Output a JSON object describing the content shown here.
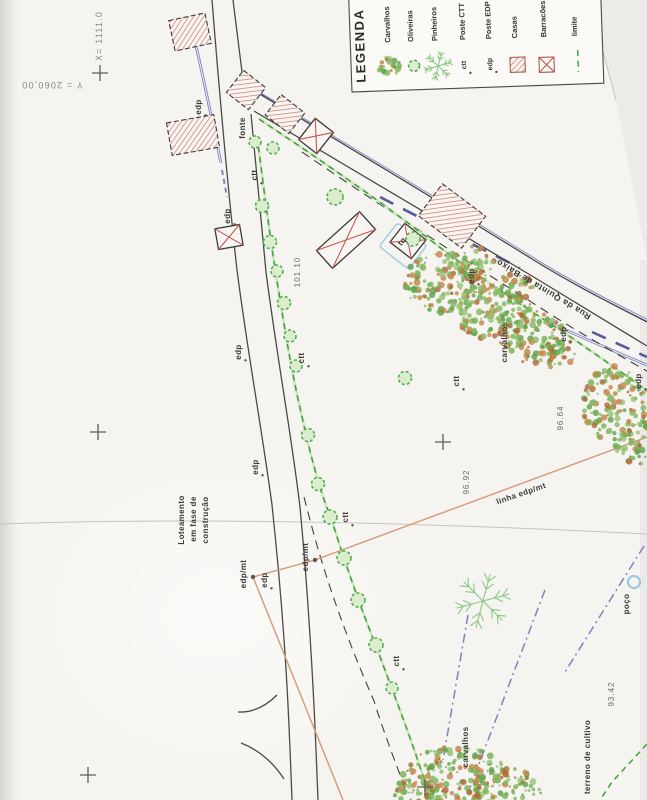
{
  "legend": {
    "title": "LEGENDA",
    "items": [
      {
        "label": "Carvalhos",
        "symbol": "oak-tree"
      },
      {
        "label": "Oliveiras",
        "symbol": "olive-tree"
      },
      {
        "label": "Pinheiros",
        "symbol": "pine-tree"
      },
      {
        "label": "Poste CTT",
        "symbol": "ctt-pole",
        "symbol_text": "ctt"
      },
      {
        "label": "Poste EDP",
        "symbol": "edp-pole",
        "symbol_text": "edp"
      },
      {
        "label": "Casas",
        "symbol": "hatched-square"
      },
      {
        "label": "Barracões",
        "symbol": "crossed-square"
      },
      {
        "label": "limite",
        "symbol": "green-dashed-line"
      }
    ]
  },
  "map": {
    "labels": [
      {
        "t": "X= 1111.0",
        "x": 102,
        "y": 36,
        "r": -90,
        "c": "coord"
      },
      {
        "t": "Y = 2060,00",
        "x": 52,
        "y": 82,
        "r": 180,
        "c": "coord"
      },
      {
        "t": "edp",
        "x": 201,
        "y": 107,
        "r": -90,
        "c": "lbl"
      },
      {
        "t": "fonte",
        "x": 245,
        "y": 128,
        "r": -90,
        "c": "lbl"
      },
      {
        "t": "ctt",
        "x": 257,
        "y": 175,
        "r": -90,
        "c": "lbl"
      },
      {
        "t": "edp",
        "x": 230,
        "y": 216,
        "r": -90,
        "c": "lbl"
      },
      {
        "t": "tq",
        "x": 404,
        "y": 243,
        "r": -52,
        "c": "lbl"
      },
      {
        "t": "101.10",
        "x": 300,
        "y": 272,
        "r": -90,
        "c": "elev"
      },
      {
        "t": "edp",
        "x": 474,
        "y": 276,
        "r": -90,
        "c": "lbl"
      },
      {
        "t": "Rua da Quinta de Baixo",
        "x": 545,
        "y": 287,
        "r": 211,
        "c": "street"
      },
      {
        "t": "carvalhos",
        "x": 507,
        "y": 342,
        "r": -90,
        "c": "lbl"
      },
      {
        "t": "edp",
        "x": 566,
        "y": 334,
        "r": -90,
        "c": "lbl"
      },
      {
        "t": "edp",
        "x": 241,
        "y": 352,
        "r": -90,
        "c": "lbl"
      },
      {
        "t": "ctt",
        "x": 304,
        "y": 358,
        "r": -90,
        "c": "lbl"
      },
      {
        "t": "ctt",
        "x": 459,
        "y": 381,
        "r": -90,
        "c": "lbl"
      },
      {
        "t": "edp",
        "x": 641,
        "y": 381,
        "r": -90,
        "c": "lbl"
      },
      {
        "t": "96.64",
        "x": 563,
        "y": 418,
        "r": -90,
        "c": "elev"
      },
      {
        "t": "edp",
        "x": 258,
        "y": 467,
        "r": -90,
        "c": "lbl"
      },
      {
        "t": "96.92",
        "x": 469,
        "y": 482,
        "r": -90,
        "c": "elev"
      },
      {
        "t": "linha edp/mt",
        "x": 522,
        "y": 496,
        "r": -19,
        "c": "lbl"
      },
      {
        "t": "ctt",
        "x": 348,
        "y": 517,
        "r": -90,
        "c": "lbl"
      },
      {
        "t": "Loteamento",
        "x": 184,
        "y": 520,
        "r": -90,
        "c": "lbl"
      },
      {
        "t": "em fase de",
        "x": 196,
        "y": 519,
        "r": -90,
        "c": "lbl"
      },
      {
        "t": "construção",
        "x": 208,
        "y": 520,
        "r": -90,
        "c": "lbl"
      },
      {
        "t": "edp/mt",
        "x": 246,
        "y": 574,
        "r": -90,
        "c": "lbl"
      },
      {
        "t": "edp/mt",
        "x": 308,
        "y": 557,
        "r": -90,
        "c": "lbl"
      },
      {
        "t": "edp",
        "x": 267,
        "y": 580,
        "r": -90,
        "c": "lbl"
      },
      {
        "t": "poço",
        "x": 629,
        "y": 604,
        "r": -90,
        "c": "lbl"
      },
      {
        "t": "ctt",
        "x": 399,
        "y": 661,
        "r": -90,
        "c": "lbl"
      },
      {
        "t": "93.42",
        "x": 614,
        "y": 694,
        "r": -90,
        "c": "elev"
      },
      {
        "t": "carvalhos",
        "x": 468,
        "y": 747,
        "r": -90,
        "c": "lbl"
      },
      {
        "t": "terreno de cultivo",
        "x": 590,
        "y": 757,
        "r": -90,
        "c": "lbl"
      }
    ],
    "paths": [
      {
        "n": "page-edge",
        "d": "M589,0 L616,100",
        "c": "fold"
      },
      {
        "n": "fold-line",
        "d": "M0,524 C200,517 430,523 647,534",
        "c": "fold"
      },
      {
        "n": "wall-blue",
        "d": "M196,46 C203,76 209,106 215,134 L221,163",
        "c": "blue2"
      },
      {
        "n": "wall-blue-dashes",
        "d": "M222,170 L227,197",
        "c": "bluedash2"
      },
      {
        "n": "roadside-blue-upper",
        "d": "M259,93 C342,142 442,202 542,264 C580,287 616,305 647,320",
        "c": "blue2"
      },
      {
        "n": "roadside-blue-lower",
        "d": "M548,322 C583,338 616,352 647,365",
        "c": "blue2"
      },
      {
        "n": "road-center-dashes-1",
        "d": "M380,197 C428,222 478,247 520,268",
        "c": "navy"
      },
      {
        "n": "road-center-dashes-2",
        "d": "M592,332 L647,357",
        "c": "navy"
      },
      {
        "n": "road-main-left",
        "d": "M212,0 C220,100 228,190 237,270 C248,355 262,430 272,505 C280,580 285,645 288,705 C290,745 291,775 292,800",
        "c": "road"
      },
      {
        "n": "road-main-right-a",
        "d": "M233,0 C238,42 241,66 244,88",
        "c": "road"
      },
      {
        "n": "road-main-right-b",
        "d": "M251,114 C256,168 262,225 266,272 C277,357 291,432 300,507 C307,582 311,646 314,706 C316,746 317,776 318,800",
        "c": "road"
      },
      {
        "n": "road-branch-upper",
        "d": "M247,86 C330,136 432,197 532,259 C572,284 612,304 647,322",
        "c": "road"
      },
      {
        "n": "road-branch-lower",
        "d": "M254,111 C336,159 432,216 532,276 C576,303 613,325 647,346",
        "c": "road"
      },
      {
        "n": "limit-black-dash-branch",
        "d": "M302,152 C382,207 470,263 558,319 C594,341 622,357 647,371",
        "c": "blkdash"
      },
      {
        "n": "limit-green-branch",
        "d": "M259,119 C322,161 382,202 442,249 C482,279 522,306 562,331 C592,352 622,372 647,391",
        "c": "green2"
      },
      {
        "n": "limit-green-main",
        "d": "M257,136 C263,182 269,231 277,281 C285,331 292,375 303,421 C312,462 321,494 331,518 C344,559 358,601 376,646 C392,689 409,733 421,770 C426,783 429,792 431,800",
        "c": "green2"
      },
      {
        "n": "limit-black-dash-main",
        "d": "M304,497 C313,532 322,566 339,613 C351,647 364,678 374,701 C387,742 397,766 406,791",
        "c": "blkdash"
      },
      {
        "n": "curb-arc-1",
        "d": "M238,712 Q259,713 277,695",
        "c": "road"
      },
      {
        "n": "curb-arc-2",
        "d": "M241,743 Q267,753 284,779",
        "c": "road"
      },
      {
        "n": "power-line-1",
        "d": "M253,577 L315,560 L647,437",
        "c": "orange"
      },
      {
        "n": "power-line-2",
        "d": "M253,577 L343,800",
        "c": "orange"
      },
      {
        "n": "field-line-1",
        "d": "M644,546 L565,672",
        "c": "bluedd"
      },
      {
        "n": "field-line-2",
        "d": "M545,590 L468,793",
        "c": "bluedd"
      },
      {
        "n": "field-line-3",
        "d": "M468,615 L443,760",
        "c": "bluedd"
      },
      {
        "n": "limit-green-corner",
        "d": "M647,744 L612,782 L600,800",
        "c": "greendash"
      }
    ],
    "buildings": [
      {
        "type": "casa",
        "cx": 190,
        "cy": 32,
        "w": 37,
        "h": 31,
        "rot": -12
      },
      {
        "type": "casa",
        "cx": 193,
        "cy": 135,
        "w": 48,
        "h": 33,
        "rot": -10
      },
      {
        "type": "casa",
        "cx": 246,
        "cy": 90,
        "w": 28,
        "h": 28,
        "rot": 38
      },
      {
        "type": "casa",
        "cx": 285,
        "cy": 114,
        "w": 30,
        "h": 26,
        "rot": 38
      },
      {
        "type": "casa",
        "cx": 452,
        "cy": 216,
        "w": 54,
        "h": 40,
        "rot": 37
      },
      {
        "type": "barracao",
        "cx": 316,
        "cy": 136,
        "w": 23,
        "h": 27,
        "rot": 38
      },
      {
        "type": "barracao",
        "cx": 229,
        "cy": 237,
        "w": 25,
        "h": 21,
        "rot": -10
      },
      {
        "type": "barracao",
        "cx": 346,
        "cy": 240,
        "w": 58,
        "h": 24,
        "rot": -42
      },
      {
        "type": "bluebox",
        "cx": 403,
        "cy": 246,
        "w": 37,
        "h": 30,
        "rot": 38
      },
      {
        "type": "barracao",
        "cx": 408,
        "cy": 241,
        "w": 27,
        "h": 24,
        "rot": 38
      }
    ],
    "olive_trees": [
      [
        255,
        142,
        6
      ],
      [
        273,
        148,
        6
      ],
      [
        335,
        197,
        8
      ],
      [
        413,
        239,
        7
      ],
      [
        262,
        206,
        6.5
      ],
      [
        270,
        242,
        6.5
      ],
      [
        277,
        271,
        6
      ],
      [
        284,
        303,
        6.5
      ],
      [
        290,
        336,
        6
      ],
      [
        296,
        366,
        6
      ],
      [
        308,
        435,
        6.5
      ],
      [
        318,
        484,
        6.5
      ],
      [
        330,
        517,
        7
      ],
      [
        344,
        558,
        7
      ],
      [
        358,
        600,
        7
      ],
      [
        376,
        645,
        7
      ],
      [
        392,
        688,
        6
      ],
      [
        405,
        378,
        6.5
      ]
    ],
    "oak_clusters": [
      [
        445,
        283,
        42,
        30
      ],
      [
        492,
        312,
        40,
        28
      ],
      [
        533,
        337,
        34,
        26
      ],
      [
        470,
        262,
        24,
        16
      ],
      [
        513,
        288,
        22,
        15
      ],
      [
        556,
        352,
        20,
        16
      ],
      [
        614,
        404,
        32,
        38
      ],
      [
        638,
        442,
        24,
        22
      ],
      [
        455,
        775,
        52,
        28
      ],
      [
        505,
        788,
        38,
        20
      ],
      [
        420,
        792,
        28,
        16
      ]
    ],
    "pine_trees": [
      [
        483,
        601,
        27
      ]
    ],
    "well": {
      "x": 634,
      "y": 582,
      "r": 6
    },
    "poles": [
      [
        253,
        577
      ],
      [
        315,
        560
      ]
    ],
    "crosses": [
      [
        100,
        73
      ],
      [
        98,
        432
      ],
      [
        443,
        442
      ],
      [
        88,
        775
      ],
      [
        425,
        787
      ]
    ]
  },
  "colors": {
    "paper": "#f5f4f0",
    "hatch_red": "#cf7f72",
    "cross_red": "#c6574d",
    "road_gray": "#4d4a46",
    "line_blue": "#8083c4",
    "line_navy": "#575a9c",
    "limit_green": "#3da23d",
    "power_orange": "#d89877",
    "field_blue": "#7f82bd",
    "well_blue": "#9cc9e2",
    "oak_palette": [
      "#76b356",
      "#97c573",
      "#5fa34a",
      "#c8854c",
      "#b06a38",
      "#86b866"
    ]
  }
}
